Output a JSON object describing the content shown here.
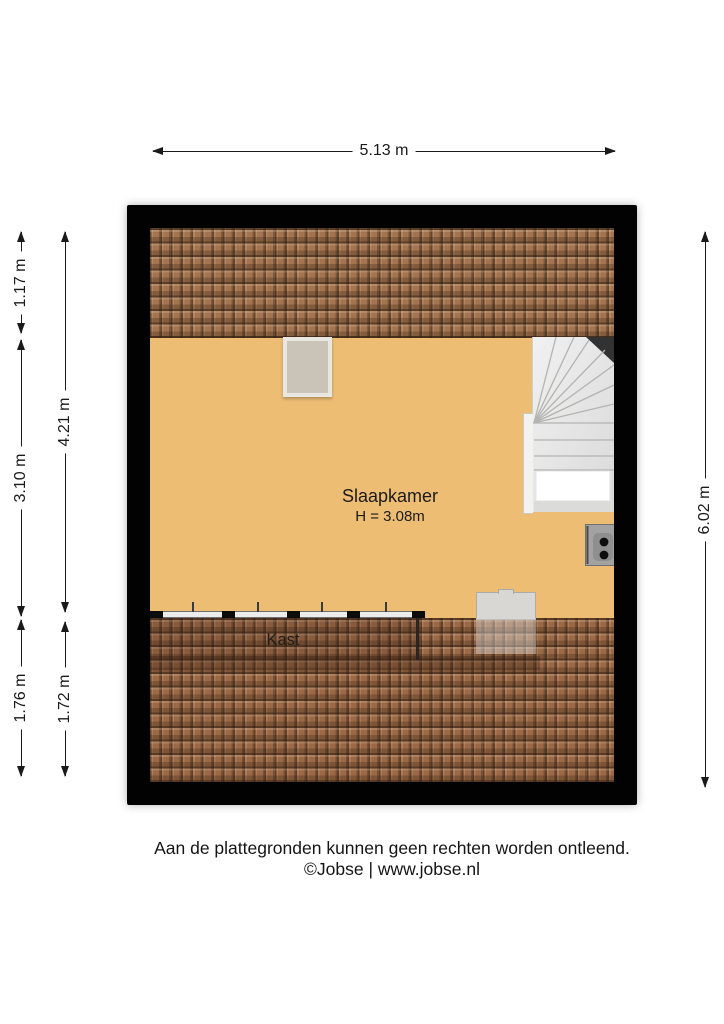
{
  "colors": {
    "wall": "#020202",
    "floor": "#eebd74",
    "roof-top": "#a3744f",
    "roof-bottom": "#9b6946",
    "stair": "#e9e9e9"
  },
  "dimensions": {
    "top": {
      "label": "5.13 m"
    },
    "left_outer": [
      {
        "label": "1.17 m"
      },
      {
        "label": "3.10 m"
      },
      {
        "label": "1.76 m"
      }
    ],
    "left_inner": [
      {
        "label": "4.21 m"
      },
      {
        "label": "1.72 m"
      }
    ],
    "right": {
      "label": "6.02 m"
    }
  },
  "floorplan": {
    "room_label": "Slaapkamer",
    "room_height": "H = 3.08m",
    "closet_label": "Kast"
  },
  "footer": {
    "line1": "Aan de plattegronden kunnen geen rechten worden ontleend.",
    "line2": "©Jobse | www.jobse.nl"
  }
}
